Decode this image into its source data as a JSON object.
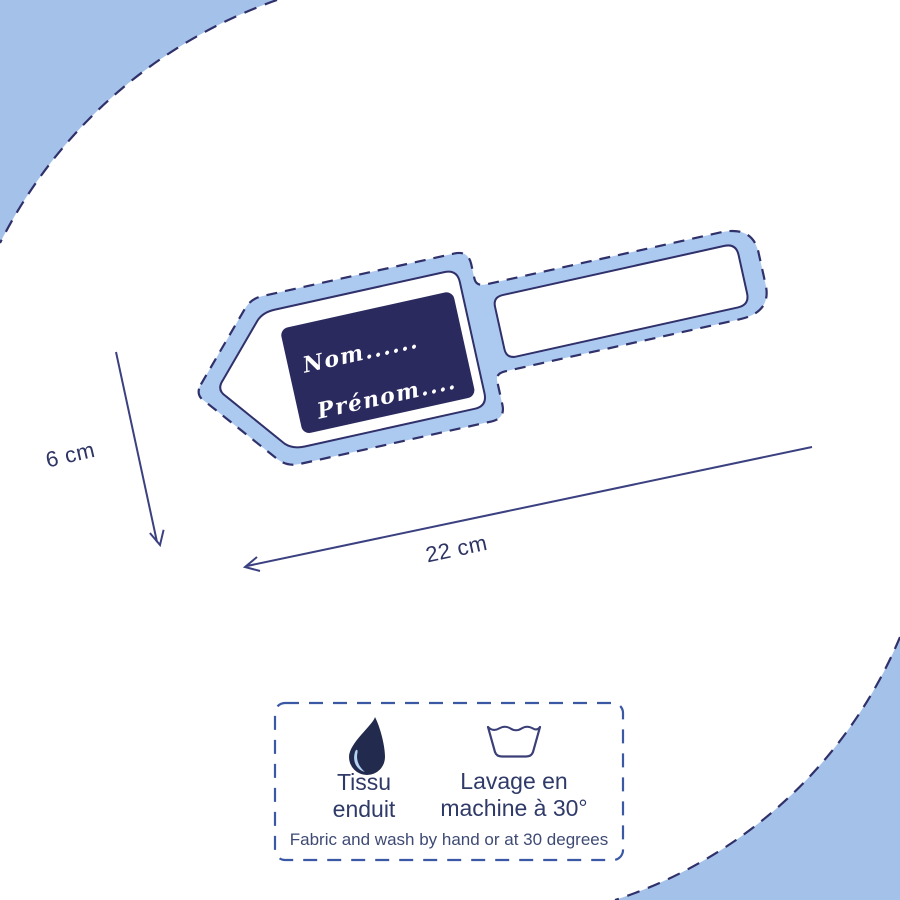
{
  "diagram": {
    "dimension_height": "6 cm",
    "dimension_width": "22 cm"
  },
  "tag_label": {
    "line1": "Nom......",
    "line2": "Prénom...."
  },
  "care_info": {
    "fabric_lines": [
      "Tissu",
      "enduit"
    ],
    "wash_lines": [
      "Lavage en",
      "machine à 30°"
    ],
    "subtitle": "Fabric and wash by hand or at 30 degrees",
    "icons": [
      "water-drop",
      "machine-wash-basin"
    ]
  },
  "colors": {
    "background_blue": "#a4c2e9",
    "tag_blue": "#accaf0",
    "label_navy": "#2b2a5f",
    "outline_navy": "#30306a",
    "drop_navy": "#222b4e",
    "drop_highlight": "#b5d2f2",
    "care_dash_blue": "#3a58a4",
    "arrow_navy": "#3b4180"
  }
}
